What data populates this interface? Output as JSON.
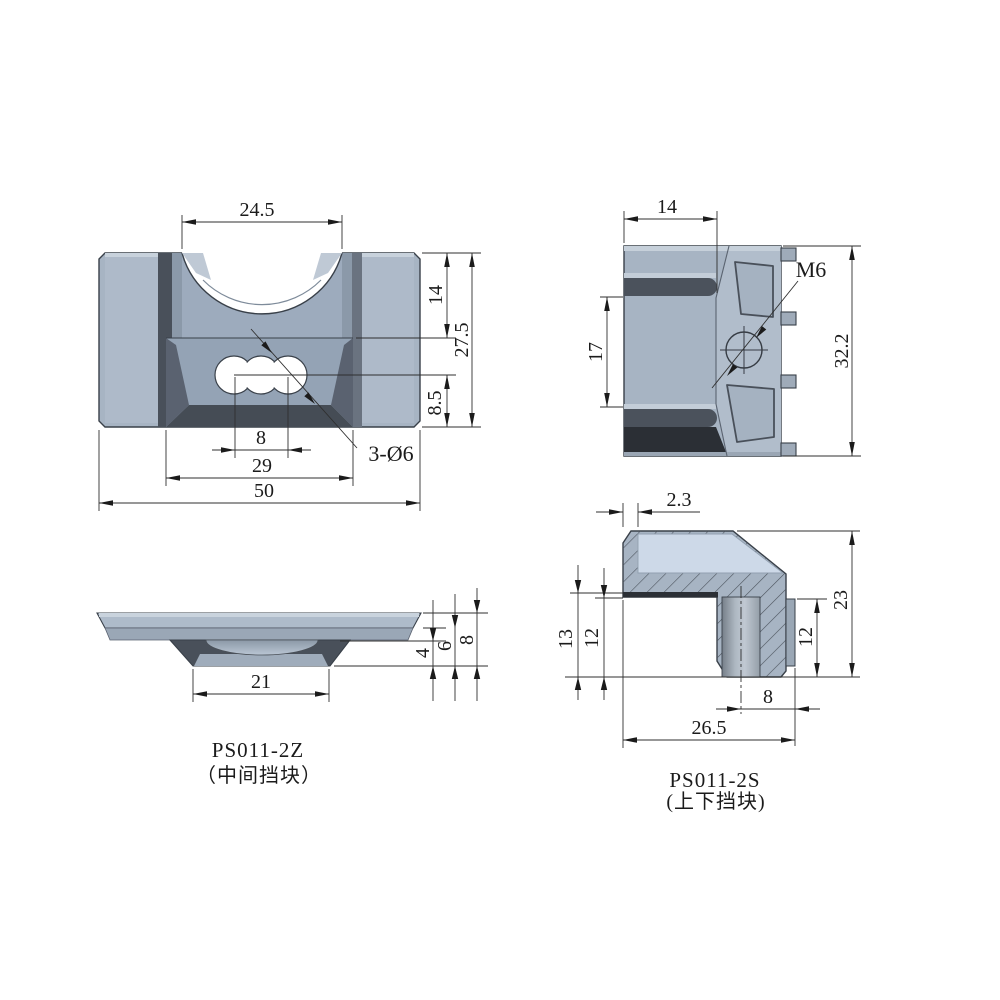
{
  "drawing": {
    "front_view": {
      "dims": {
        "notch_width": "24.5",
        "upper_height": "14",
        "total_height": "27.5",
        "lower_height": "8.5",
        "hole_pitch": "8",
        "recess_width": "29",
        "total_width": "50",
        "holes_callout": "3-Ø6"
      }
    },
    "side_view": {
      "dims": {
        "top_width": "14",
        "groove_span": "17",
        "total_height": "32.2",
        "thread_callout": "M6"
      }
    },
    "profile_view": {
      "part_no": "PS011-2Z",
      "part_name": "（中间挡块）",
      "dims": {
        "boss_width": "21",
        "step_depth": "4",
        "dish_depth": "6",
        "total_height": "8"
      }
    },
    "section_view": {
      "part_no": "PS011-2S",
      "part_name": "(上下挡块)",
      "dims": {
        "wall_thickness": "2.3",
        "left_outer_height": "13",
        "left_inner_height": "12",
        "total_height": "23",
        "right_height": "12",
        "bore_offset": "8",
        "total_width": "26.5"
      }
    }
  },
  "colors": {
    "body": "#a7b4c3",
    "body_light": "#b0bcca",
    "body_dark": "#49505a",
    "underside": "#2b2f35",
    "section_face": "#cdd9e8",
    "line": "#2b2b2b",
    "background": "#ffffff"
  }
}
